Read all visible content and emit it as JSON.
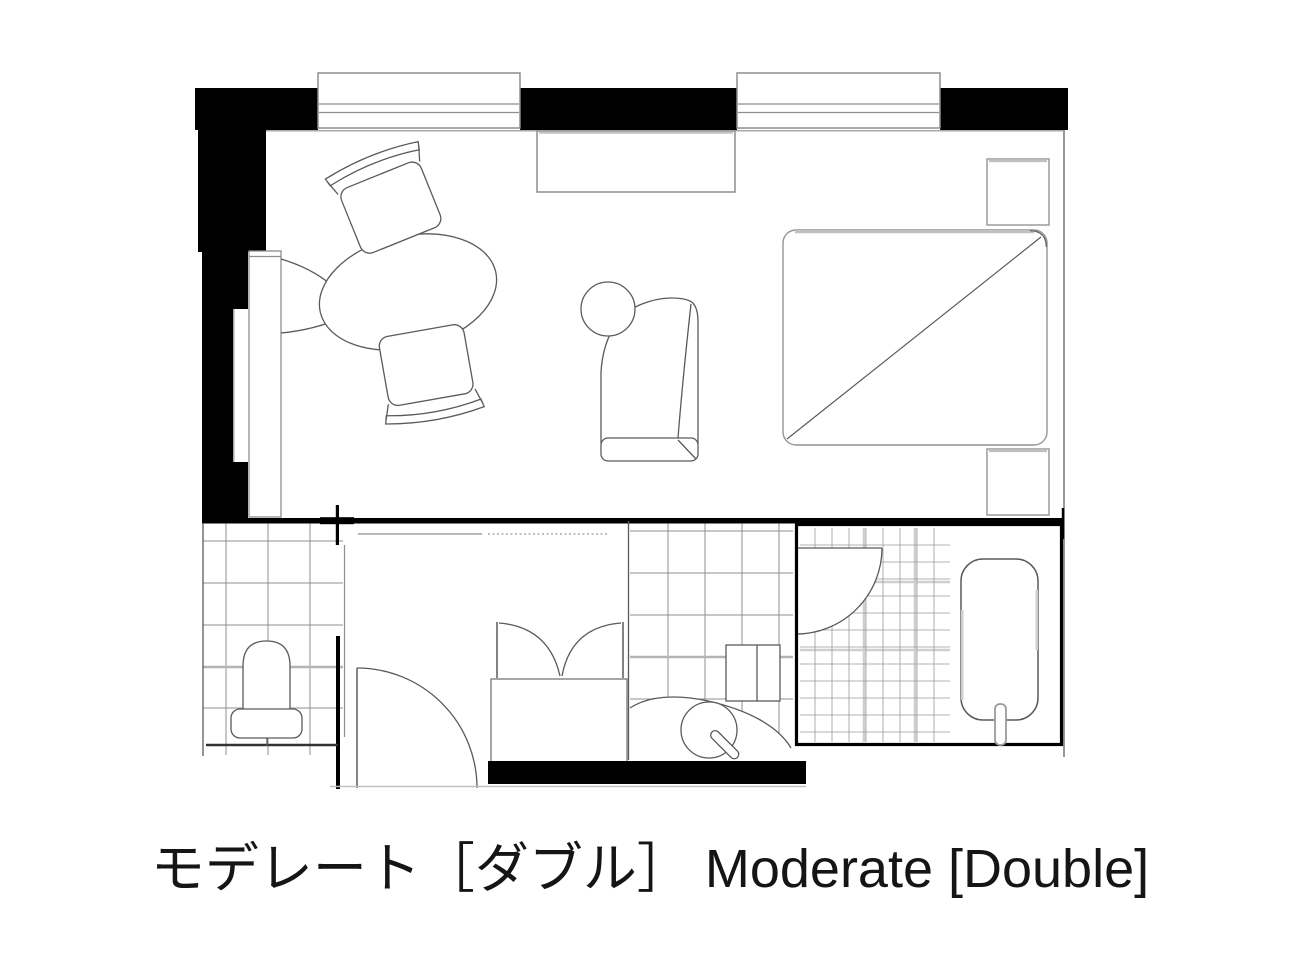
{
  "caption": {
    "jp": "モデレート［ダブル］",
    "en": "Moderate [Double]"
  },
  "colors": {
    "wall": "#000000",
    "line": "#5a5a5a",
    "line_light": "#8e8e8e",
    "tile": "#8f8f8f",
    "tile_fine": "#9a9a9a",
    "tile_accent": "#cfcfcf",
    "highlight": "#c0c0c0",
    "text": "#151515",
    "background": "#ffffff"
  }
}
